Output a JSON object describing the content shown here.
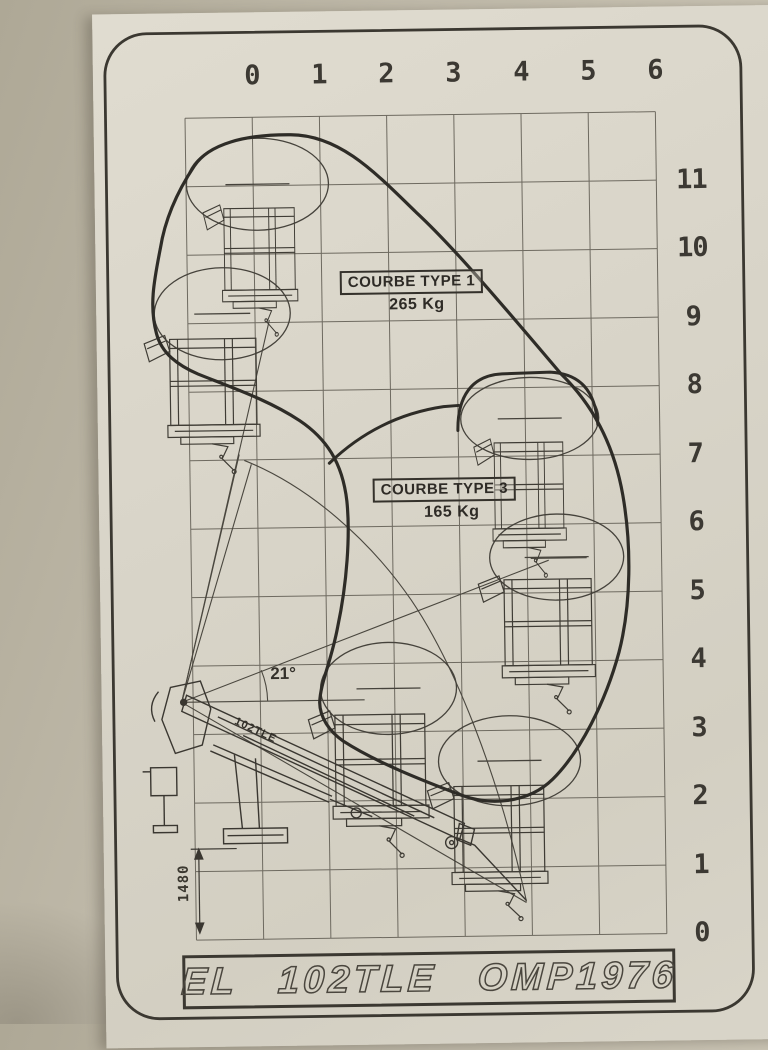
{
  "photo": {
    "wall_color": "#bfb9a9",
    "sticker_color": "#d8d4c8",
    "ink_color": "#37342e"
  },
  "axes": {
    "top_labels": [
      "0",
      "1",
      "2",
      "3",
      "4",
      "5",
      "6"
    ],
    "right_labels": [
      "11",
      "10",
      "9",
      "8",
      "7",
      "6",
      "5",
      "4",
      "3",
      "2",
      "1",
      "0"
    ]
  },
  "curves": [
    {
      "label": "COURBE TYPE 1",
      "load": "265 Kg"
    },
    {
      "label": "COURBE TYPE 3",
      "load": "165 Kg"
    }
  ],
  "annotations": {
    "boom_angle": "21°",
    "height_dimension": "1480",
    "boom_model": "102TLE"
  },
  "title_plate": {
    "text": "EL 102TLE OMP1976"
  }
}
